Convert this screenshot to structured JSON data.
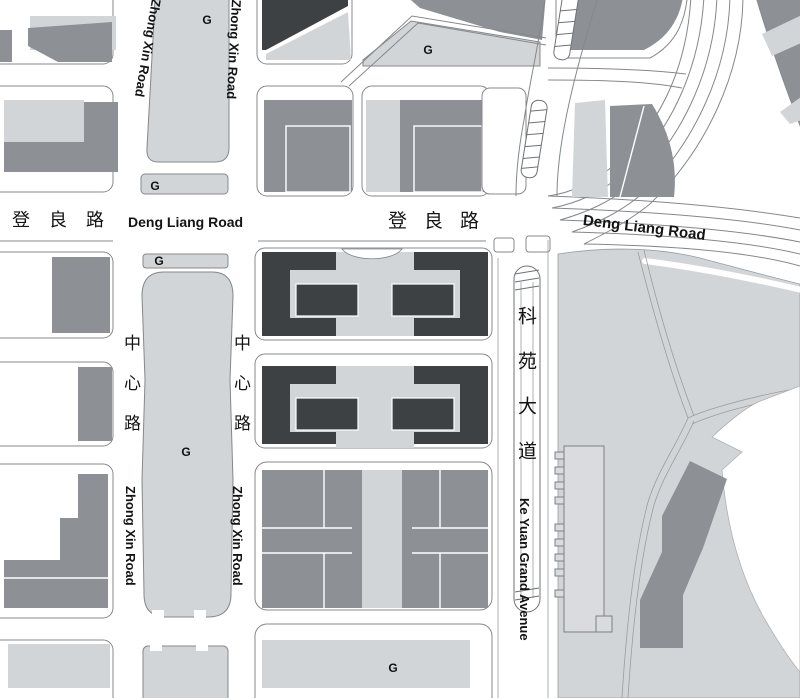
{
  "map_title": "urban district street map",
  "colors": {
    "background": "#ffffff",
    "greenspace": "#d2d5d8",
    "building": "#8d9196",
    "building_dark": "#3e4144",
    "line": "#85888b",
    "label": "#141414"
  },
  "roads": {
    "deng_liang": {
      "cn": "登良路",
      "en": "Deng Liang Road"
    },
    "zhong_xin": {
      "cn": "中心路",
      "en": "Zhong Xin Road"
    },
    "ke_yuan": {
      "cn": "科苑大道",
      "en": "Ke Yuan Grand Avenue"
    }
  },
  "markers": {
    "greenspace": "G"
  }
}
